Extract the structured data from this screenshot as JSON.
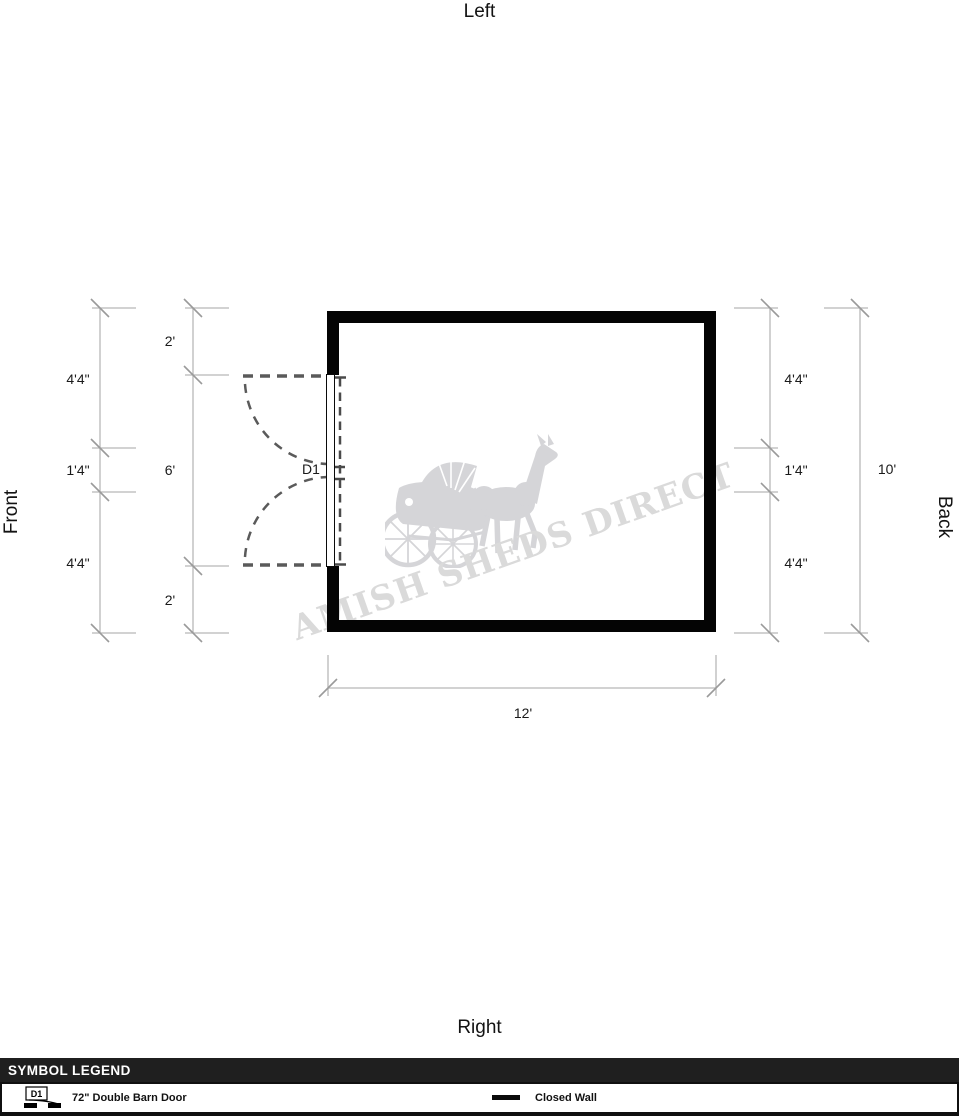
{
  "orientation_labels": {
    "top": "Left",
    "bottom": "Right",
    "left": "Front",
    "right": "Back"
  },
  "plan": {
    "door": {
      "id": "D1"
    },
    "dimensions": {
      "left_outer": [
        "4'4\"",
        "1'4\"",
        "4'4\""
      ],
      "left_inner": [
        "2'",
        "6'",
        "2'"
      ],
      "right_inner": [
        "4'4\"",
        "1'4\"",
        "4'4\""
      ],
      "right_outer": "10'",
      "bottom": "12'"
    }
  },
  "watermark": {
    "text": "AMISH SHEDS DIRECT",
    "icon": "horse-and-buggy-icon"
  },
  "legend": {
    "title": "SYMBOL LEGEND",
    "items": [
      {
        "symbol": "D1",
        "label": "72\" Double Barn Door"
      },
      {
        "symbol": "closed-wall",
        "label": "Closed Wall"
      }
    ]
  },
  "colors": {
    "wall": "#040404",
    "dimension_line": "#b8b8b8",
    "tick_mark": "#9a9a9a",
    "door_dash": "#555555",
    "watermark": "#d8d8da",
    "legend_header_bg": "#1f1f1f",
    "legend_header_text": "#ffffff"
  }
}
